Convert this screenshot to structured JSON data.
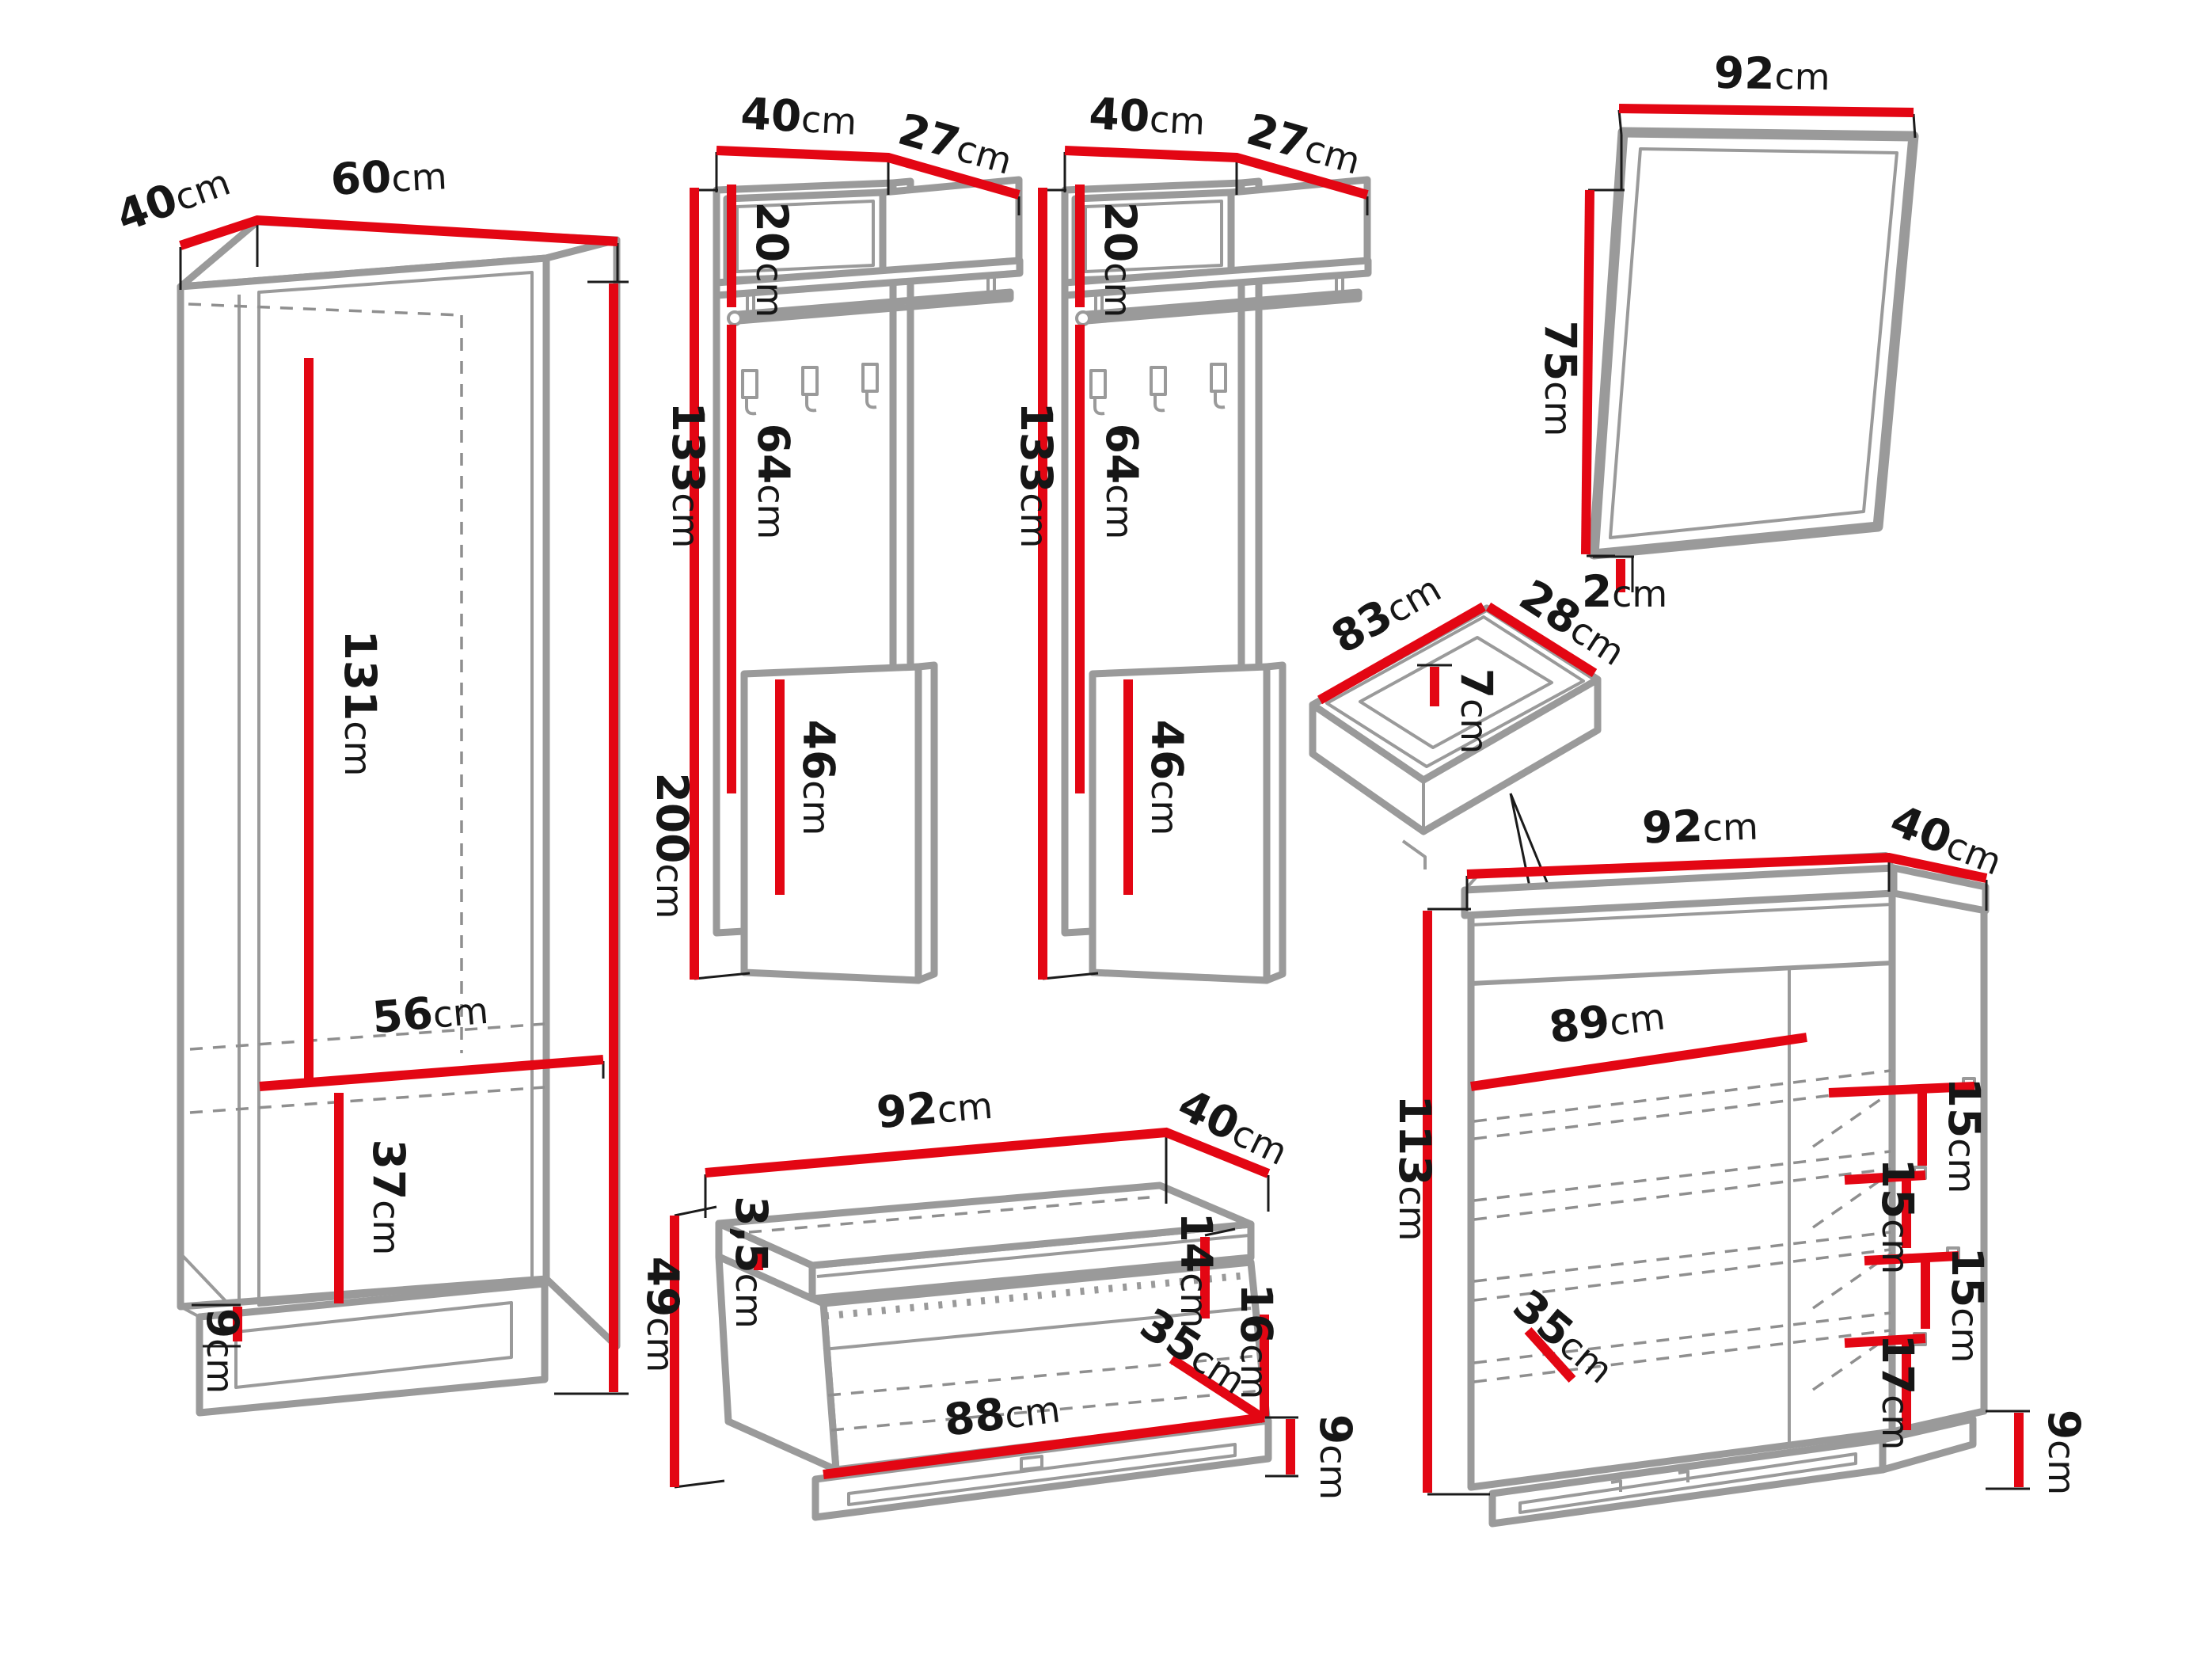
{
  "unit": "cm",
  "colors": {
    "red": "#e30613",
    "gray": "#9a9a9a"
  },
  "wardrobe": {
    "depth": "40",
    "width": "60",
    "height": "200",
    "interior_height": "131",
    "interior_width": "56",
    "lower_compartment": "37",
    "plinth_height": "9"
  },
  "coat_panel": {
    "width": "40",
    "depth": "27",
    "top_box_height": "20",
    "rail_section_height": "64",
    "lower_panel_height": "46",
    "height": "133"
  },
  "mirror": {
    "width": "92",
    "height": "75",
    "depth": "2"
  },
  "drawer": {
    "width": "83",
    "depth": "28",
    "height": "7"
  },
  "bench": {
    "width": "92",
    "depth": "40",
    "height": "49",
    "seat_thickness": "3,5",
    "inner_top_height": "14",
    "opening_height": "16",
    "inner_depth": "35",
    "inner_width": "88",
    "plinth_height": "9"
  },
  "shoe_cabinet": {
    "width": "92",
    "depth": "40",
    "height": "113",
    "interior_width": "89",
    "shelf_gap_1": "15",
    "shelf_gap_2": "15",
    "shelf_gap_3": "15",
    "shelf_gap_4": "17",
    "shelf_depth": "35",
    "plinth_height": "9"
  }
}
